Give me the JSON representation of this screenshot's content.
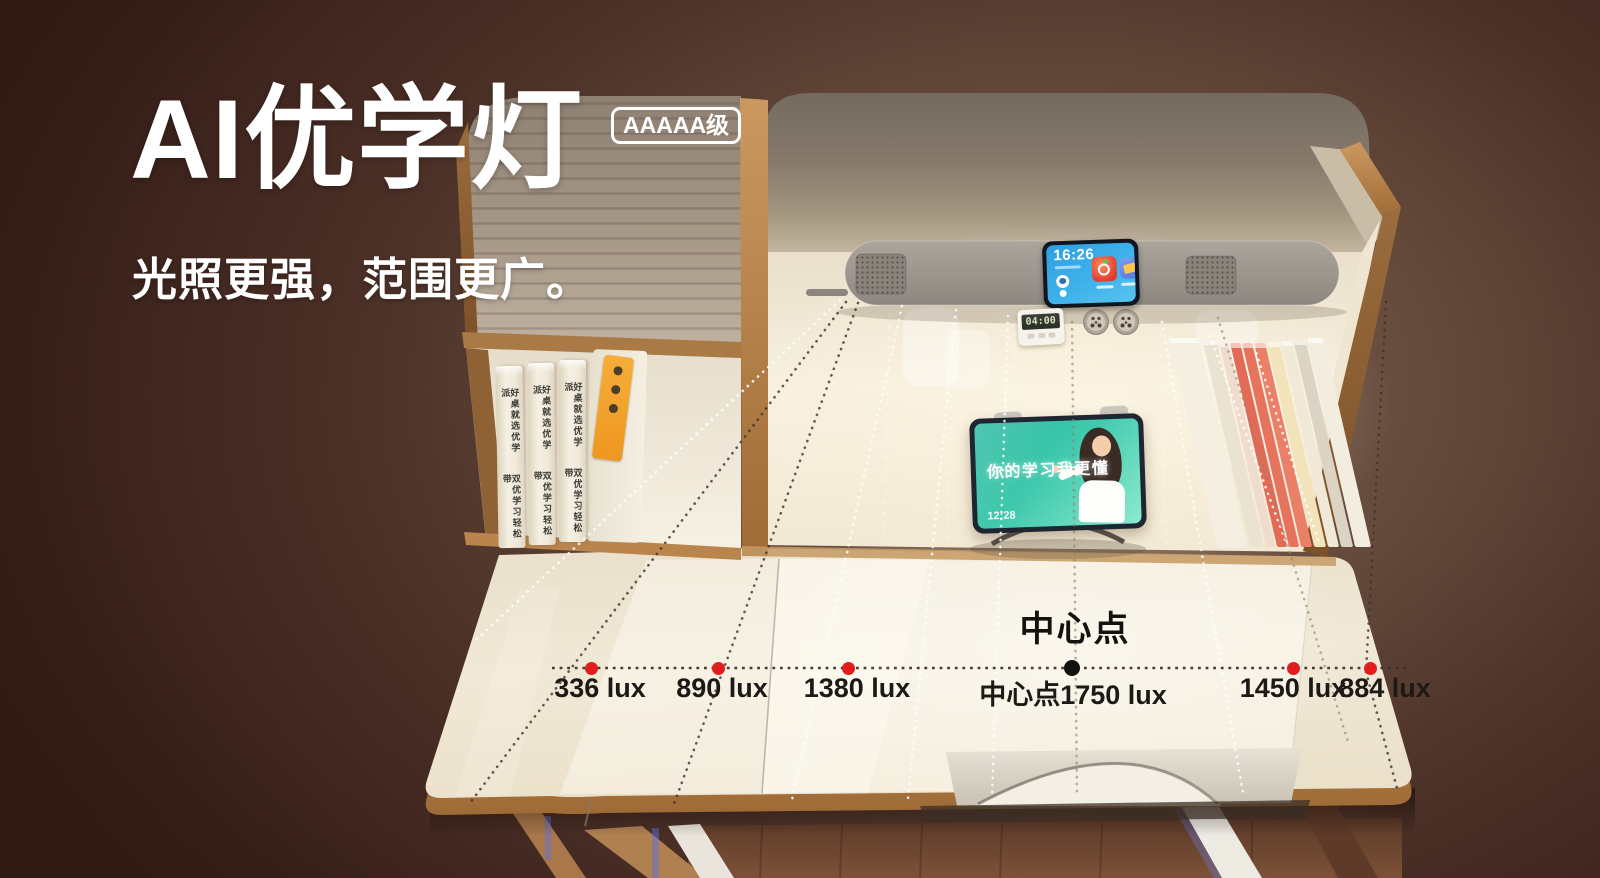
{
  "banner": {
    "title": "AI优学灯",
    "grade_badge": "AAAAA级",
    "subtitle": "光照更强，范围更广。"
  },
  "lamp": {
    "clock_time": "16:26"
  },
  "timer": {
    "display": "04:00"
  },
  "tablet": {
    "screen_slogan": "你的学习我更懂",
    "screen_time": "12:28"
  },
  "bookshelf": {
    "spine_text_top": "好桌就选优学派",
    "spine_text_bottom": "双优学习轻松带"
  },
  "measurements": {
    "center_point_label": "中心点",
    "unit": "lux",
    "points": [
      {
        "label": "336 lux",
        "value": 336,
        "dot_color": "#e01e1e"
      },
      {
        "label": "890 lux",
        "value": 890,
        "dot_color": "#e01e1e"
      },
      {
        "label": "1380 lux",
        "value": 1380,
        "dot_color": "#e01e1e"
      },
      {
        "label": "中心点1750 lux",
        "value": 1750,
        "dot_color": "#121212",
        "is_center": true
      },
      {
        "label": "1450 lux",
        "value": 1450,
        "dot_color": "#e01e1e"
      },
      {
        "label": "884 lux",
        "value": 884,
        "dot_color": "#e01e1e"
      }
    ]
  },
  "colors": {
    "background_dark": "#35201a",
    "background_warm": "#6e5547",
    "accent_red": "#e01e1e",
    "wood": "#b9834c",
    "desk_surface": "#f0e8d6",
    "lamp_grey": "#9c958d",
    "screen_blue": "#2f9fe0",
    "tablet_teal": "#27b89e",
    "text_light": "#ffffff",
    "text_dark": "#1c1916"
  }
}
